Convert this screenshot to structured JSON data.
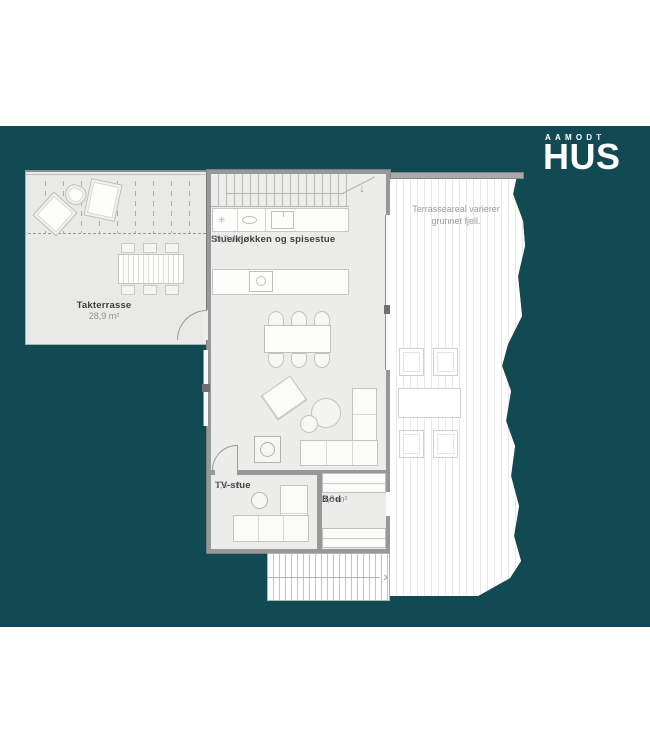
{
  "logo": {
    "top": "AAMODT",
    "main": "HUS"
  },
  "rooms": {
    "takterrasse": {
      "name": "Takterrasse",
      "area": "28,9 m²"
    },
    "stue": {
      "name": "Stue/kjøkken og spisestue",
      "area": "50,3 m²"
    },
    "tv_stue": {
      "name": "TV-stue",
      "area": "7,4 m²"
    },
    "bod": {
      "name": "Bod",
      "area": "4,8 m²"
    }
  },
  "notes": {
    "terrace_line1": "Terrasseareal varierer",
    "terrace_line2": "grunnet fjell."
  },
  "icons": {
    "stair_down_arrow": "↓",
    "stair_right_arrow": "›",
    "burner": "✳"
  },
  "colors": {
    "background_band": "#124a54",
    "plan_fill": "#ececea",
    "terrace_fill": "#e9e9e7",
    "wall": "#97989a",
    "label_dark": "#3e3e3e",
    "label_light": "#8f9091"
  }
}
